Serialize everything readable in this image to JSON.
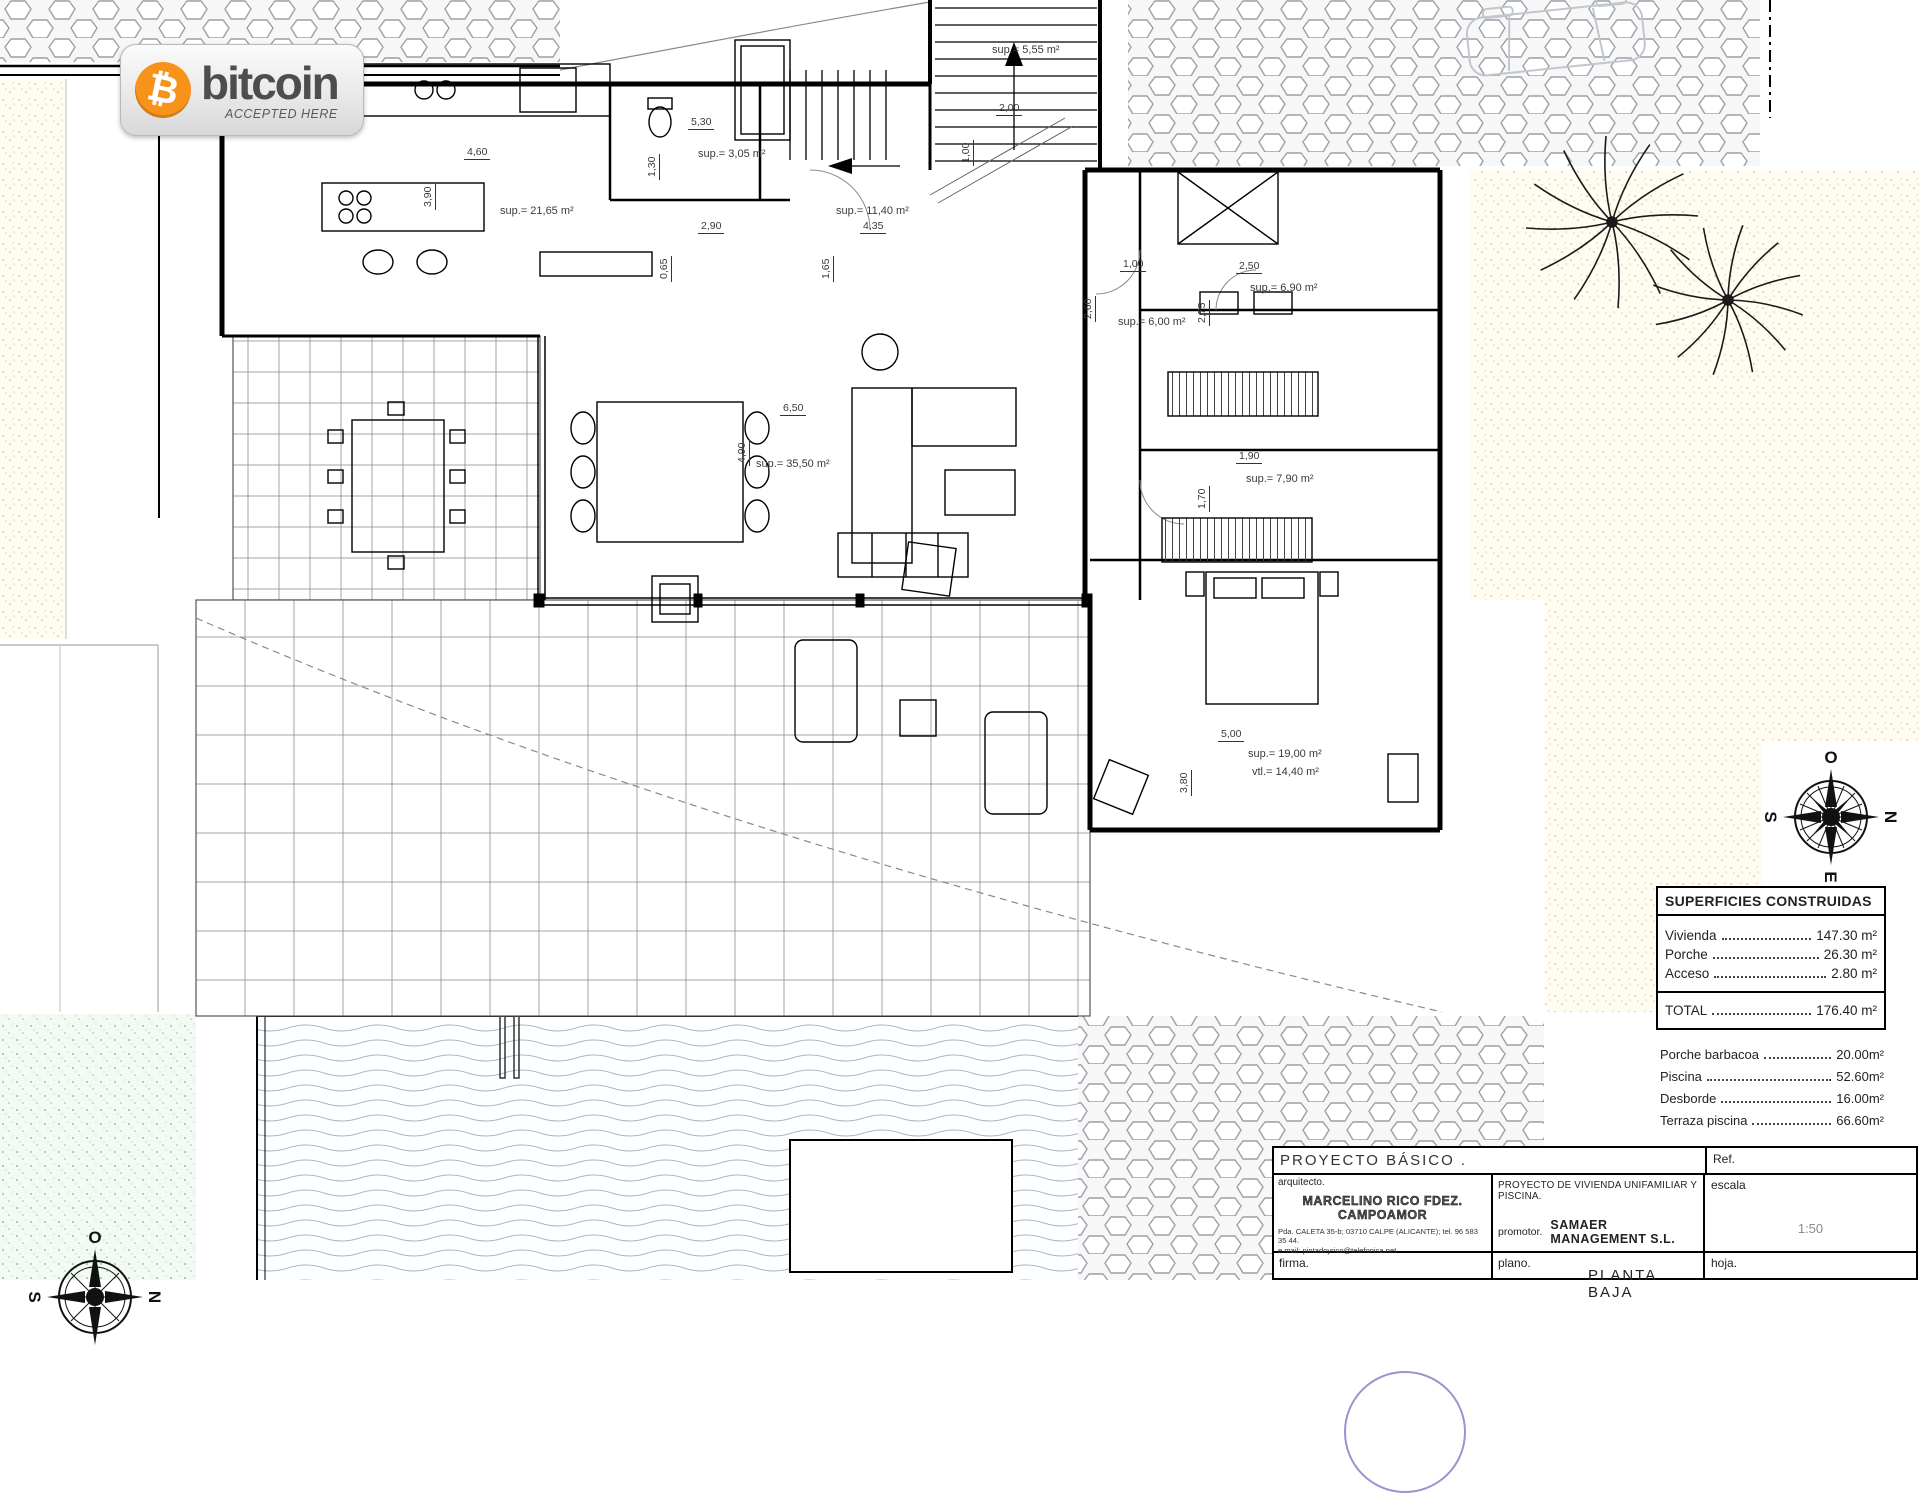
{
  "badge": {
    "brand": "bitcoin",
    "tagline": "ACCEPTED HERE",
    "symbol": "₿",
    "orange": "#f7931a",
    "text_color": "#4d4d4d"
  },
  "compass": {
    "top": "O",
    "right": "N",
    "bottom": "E",
    "left": "S"
  },
  "plan_labels": [
    {
      "text": "sup.= 21,65 m²",
      "x": 500,
      "y": 205
    },
    {
      "text": "sup.= 3,05 m²",
      "x": 698,
      "y": 148
    },
    {
      "text": "sup.= 11,40 m²",
      "x": 836,
      "y": 205
    },
    {
      "text": "sup.= 5,55 m²",
      "x": 992,
      "y": 44
    },
    {
      "text": "sup.= 35,50 m²",
      "x": 756,
      "y": 458
    },
    {
      "text": "sup.= 6,00 m²",
      "x": 1118,
      "y": 316
    },
    {
      "text": "sup.= 6,90 m²",
      "x": 1250,
      "y": 282
    },
    {
      "text": "sup.= 7,90 m²",
      "x": 1246,
      "y": 473
    },
    {
      "text": "sup.= 19,00 m²",
      "x": 1248,
      "y": 748
    },
    {
      "text": "vtl.= 14,40 m²",
      "x": 1252,
      "y": 766
    }
  ],
  "dim_labels": [
    {
      "text": "4,60",
      "x": 464,
      "y": 146,
      "vert": false
    },
    {
      "text": "3,90",
      "x": 436,
      "y": 196,
      "vert": true
    },
    {
      "text": "5,30",
      "x": 688,
      "y": 116,
      "vert": false
    },
    {
      "text": "1,30",
      "x": 660,
      "y": 166,
      "vert": true
    },
    {
      "text": "2,90",
      "x": 698,
      "y": 220,
      "vert": false
    },
    {
      "text": "0,65",
      "x": 672,
      "y": 268,
      "vert": true
    },
    {
      "text": "4,35",
      "x": 860,
      "y": 220,
      "vert": false
    },
    {
      "text": "1,65",
      "x": 834,
      "y": 268,
      "vert": true
    },
    {
      "text": "6,50",
      "x": 780,
      "y": 402,
      "vert": false
    },
    {
      "text": "4,90",
      "x": 750,
      "y": 452,
      "vert": true
    },
    {
      "text": "2,00",
      "x": 996,
      "y": 102,
      "vert": false
    },
    {
      "text": "1,00",
      "x": 974,
      "y": 152,
      "vert": true
    },
    {
      "text": "1,00",
      "x": 1120,
      "y": 258,
      "vert": false
    },
    {
      "text": "2,60",
      "x": 1096,
      "y": 308,
      "vert": true
    },
    {
      "text": "2,50",
      "x": 1236,
      "y": 260,
      "vert": false
    },
    {
      "text": "2,75",
      "x": 1210,
      "y": 312,
      "vert": true
    },
    {
      "text": "1,90",
      "x": 1236,
      "y": 450,
      "vert": false
    },
    {
      "text": "1,70",
      "x": 1210,
      "y": 498,
      "vert": true
    },
    {
      "text": "5,00",
      "x": 1218,
      "y": 728,
      "vert": false
    },
    {
      "text": "3,80",
      "x": 1192,
      "y": 782,
      "vert": true
    }
  ],
  "superficies": {
    "title": "SUPERFICIES CONSTRUIDAS",
    "rows": [
      {
        "label": "Vivienda",
        "value": "147.30 m²"
      },
      {
        "label": "Porche",
        "value": "26.30 m²"
      },
      {
        "label": "Acceso",
        "value": "2.80 m²"
      }
    ],
    "total": {
      "label": "TOTAL",
      "value": "176.40 m²"
    },
    "extras": [
      {
        "label": "Porche barbacoa",
        "value": "20.00m²"
      },
      {
        "label": "Piscina",
        "value": "52.60m²"
      },
      {
        "label": "Desborde",
        "value": "16.00m²"
      },
      {
        "label": "Terraza piscina",
        "value": "66.60m²"
      }
    ]
  },
  "titleblock": {
    "project_type": "PROYECTO BÁSICO .",
    "ref_label": "Ref.",
    "arquitecto_label": "arquitecto.",
    "architect_name": "MARCELINO RICO FDEZ. CAMPOAMOR",
    "architect_address": "Pda. CALETA 35-b; 03710 CALPE (ALICANTE); tel. 96 583 35 44.",
    "architect_email": "e.mail: pintadoyrico@telefonica.net",
    "project_title": "PROYECTO DE VIVIENDA UNIFAMILIAR Y PISCINA.",
    "promotor_label": "promotor.",
    "promotor_name": "SAMAER MANAGEMENT S.L.",
    "escala_label": "escala",
    "escala_value": "1:50",
    "firma_label": "firma.",
    "plano_label": "plano.",
    "plano_value": "PLANTA BAJA",
    "hoja_label": "hoja."
  }
}
